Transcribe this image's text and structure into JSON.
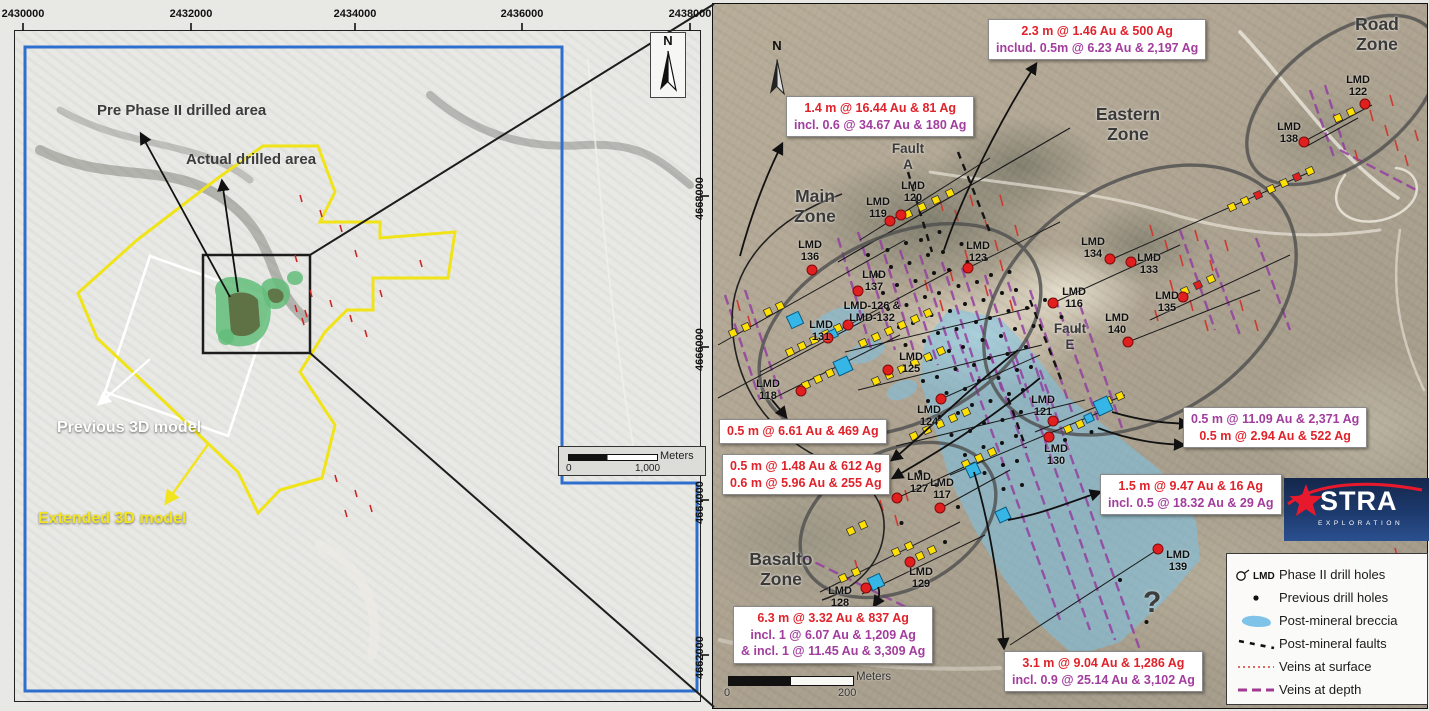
{
  "left_panel": {
    "top_coords": [
      {
        "text": "2430000",
        "x": 23
      },
      {
        "text": "2432000",
        "x": 191
      },
      {
        "text": "2434000",
        "x": 355
      },
      {
        "text": "2436000",
        "x": 522
      },
      {
        "text": "2438000",
        "x": 690
      }
    ],
    "right_coords": [
      {
        "text": "4668000",
        "y": 196
      },
      {
        "text": "4666000",
        "y": 347
      },
      {
        "text": "4664000",
        "y": 500
      },
      {
        "text": "4662000",
        "y": 655
      }
    ],
    "labels": {
      "pre_phase": "Pre Phase II drilled area",
      "actual": "Actual drilled area",
      "previous_model": "Previous 3D model",
      "extended_model": "Extended 3D model"
    },
    "north_label": "N",
    "scalebar": {
      "unit": "Meters",
      "start": "0",
      "end": "1,000"
    }
  },
  "right_panel": {
    "north_label": "N",
    "question_mark": "?",
    "zone_labels": [
      {
        "lines": "Main\nZone",
        "x": 815,
        "y": 186,
        "size": 17.5
      },
      {
        "lines": "Eastern\nZone",
        "x": 1128,
        "y": 104,
        "size": 17.5
      },
      {
        "lines": "Road\nZone",
        "x": 1377,
        "y": 14,
        "size": 17.5
      },
      {
        "lines": "Basalto\nZone",
        "x": 781,
        "y": 549,
        "size": 17.5
      },
      {
        "lines": "Fault\nA",
        "x": 908,
        "y": 141,
        "size": 13.5
      },
      {
        "lines": "Fault\nE",
        "x": 1070,
        "y": 321,
        "size": 13.5
      }
    ],
    "assay_boxes": [
      {
        "x": 988,
        "y": 19,
        "lines": [
          {
            "text": "2.3 m @ 1.46 Au & 500 Ag",
            "color": "red"
          },
          {
            "text": "includ. 0.5m @ 6.23 Au & 2,197 Ag",
            "color": "purple"
          }
        ]
      },
      {
        "x": 786,
        "y": 96,
        "lines": [
          {
            "text": "1.4 m @ 16.44 Au & 81 Ag",
            "color": "red"
          },
          {
            "text": "incl. 0.6 @ 34.67 Au & 180 Ag",
            "color": "purple"
          }
        ]
      },
      {
        "x": 719,
        "y": 419,
        "lines": [
          {
            "text": "0.5 m @ 6.61 Au & 469 Ag",
            "color": "red"
          }
        ]
      },
      {
        "x": 722,
        "y": 454,
        "lines": [
          {
            "text": "0.5 m @ 1.48 Au & 612 Ag",
            "color": "red"
          },
          {
            "text": "0.6 m @ 5.96 Au & 255 Ag",
            "color": "red"
          }
        ]
      },
      {
        "x": 1183,
        "y": 407,
        "lines": [
          {
            "text": "0.5 m @ 11.09 Au & 2,371 Ag",
            "color": "purple"
          },
          {
            "text": "0.5 m @ 2.94 Au & 522 Ag",
            "color": "red"
          }
        ]
      },
      {
        "x": 1100,
        "y": 474,
        "lines": [
          {
            "text": "1.5 m @ 9.47 Au & 16 Ag",
            "color": "red"
          },
          {
            "text": "incl. 0.5 @ 18.32 Au & 29 Ag",
            "color": "purple"
          }
        ]
      },
      {
        "x": 733,
        "y": 606,
        "lines": [
          {
            "text": "6.3 m @ 3.32 Au & 837 Ag",
            "color": "red"
          },
          {
            "text": "incl. 1 @ 6.07 Au & 1,209 Ag",
            "color": "purple"
          },
          {
            "text": "& incl. 1 @ 11.45 Au & 3,309 Ag",
            "color": "purple"
          }
        ]
      },
      {
        "x": 1004,
        "y": 651,
        "lines": [
          {
            "text": "3.1 m @ 9.04 Au & 1,286 Ag",
            "color": "red"
          },
          {
            "text": "incl. 0.9 @ 25.14 Au & 3,102 Ag",
            "color": "purple"
          }
        ]
      }
    ],
    "drill_holes": [
      {
        "label": "LMD\n116",
        "x": 1074,
        "y": 286,
        "dot": [
          1053,
          303
        ]
      },
      {
        "label": "LMD\n117",
        "x": 942,
        "y": 477,
        "dot": [
          940,
          508
        ]
      },
      {
        "label": "LMD\n118",
        "x": 768,
        "y": 378,
        "dot": [
          801,
          391
        ]
      },
      {
        "label": "LMD\n119",
        "x": 878,
        "y": 196,
        "dot": [
          890,
          221
        ]
      },
      {
        "label": "LMD\n120",
        "x": 913,
        "y": 180,
        "dot": [
          901,
          215
        ]
      },
      {
        "label": "LMD\n121",
        "x": 1043,
        "y": 394,
        "dot": [
          1053,
          421
        ]
      },
      {
        "label": "LMD\n122",
        "x": 1358,
        "y": 74,
        "dot": [
          1365,
          104
        ]
      },
      {
        "label": "LMD\n123",
        "x": 978,
        "y": 240,
        "dot": [
          968,
          268
        ]
      },
      {
        "label": "LMD\n124",
        "x": 929,
        "y": 404,
        "dot": [
          941,
          399
        ]
      },
      {
        "label": "LMD\n125",
        "x": 911,
        "y": 351,
        "dot": [
          888,
          370
        ]
      },
      {
        "label": "LMD-126 &\nLMD-132",
        "x": 872,
        "y": 300,
        "dot": [
          848,
          325
        ]
      },
      {
        "label": "LMD\n127",
        "x": 919,
        "y": 471,
        "dot": [
          897,
          498
        ]
      },
      {
        "label": "LMD\n128",
        "x": 840,
        "y": 585,
        "dot": [
          866,
          588
        ]
      },
      {
        "label": "LMD\n129",
        "x": 921,
        "y": 566,
        "dot": [
          910,
          562
        ]
      },
      {
        "label": "LMD\n130",
        "x": 1056,
        "y": 443,
        "dot": [
          1049,
          437
        ]
      },
      {
        "label": "LMD\n131",
        "x": 821,
        "y": 319,
        "dot": [
          828,
          338
        ]
      },
      {
        "label": "LMD\n133",
        "x": 1149,
        "y": 252,
        "dot": [
          1131,
          262
        ]
      },
      {
        "label": "LMD\n134",
        "x": 1093,
        "y": 236,
        "dot": [
          1110,
          259
        ]
      },
      {
        "label": "LMD\n135",
        "x": 1167,
        "y": 290,
        "dot": [
          1183,
          297
        ]
      },
      {
        "label": "LMD\n136",
        "x": 810,
        "y": 239,
        "dot": [
          812,
          270
        ]
      },
      {
        "label": "LMD\n137",
        "x": 874,
        "y": 269,
        "dot": [
          858,
          291
        ]
      },
      {
        "label": "LMD\n138",
        "x": 1289,
        "y": 121,
        "dot": [
          1304,
          142
        ]
      },
      {
        "label": "LMD\n139",
        "x": 1178,
        "y": 549,
        "dot": [
          1158,
          549
        ]
      },
      {
        "label": "LMD\n140",
        "x": 1117,
        "y": 312,
        "dot": [
          1128,
          342
        ]
      }
    ],
    "legend": {
      "items": [
        {
          "sym": "phase2",
          "symbol_text": "LMD",
          "label": "Phase II drill holes"
        },
        {
          "sym": "previous",
          "label": "Previous drill holes"
        },
        {
          "sym": "breccia",
          "label": "Post-mineral breccia"
        },
        {
          "sym": "faults",
          "label": "Post-mineral faults"
        },
        {
          "sym": "veins-surface",
          "label": "Veins at surface"
        },
        {
          "sym": "veins-depth",
          "label": "Veins at depth"
        }
      ]
    },
    "logo": {
      "brand": "STRA",
      "sub": "EXPLORATION"
    },
    "scalebar": {
      "unit": "Meters",
      "start": "0",
      "end": "200"
    }
  },
  "colors": {
    "assay_red": "#e0222b",
    "assay_purple": "#a23d9d",
    "zone_label": "#3a3a3a",
    "phase2_dot": "#e11f1f",
    "previous_dot": "#111111",
    "breccia_fill": "#7fc3e8",
    "vein_surface": "#cf3a30",
    "vein_depth": "#9340a0",
    "extended_model_outline": "#f0e418",
    "previous_model_outline": "#ffffff",
    "boundary_blue": "#2e6fce",
    "zone_ellipse": "#4e4e4e",
    "marker_yellow": "#ffe000",
    "breccia_square": "#35b6e6"
  }
}
